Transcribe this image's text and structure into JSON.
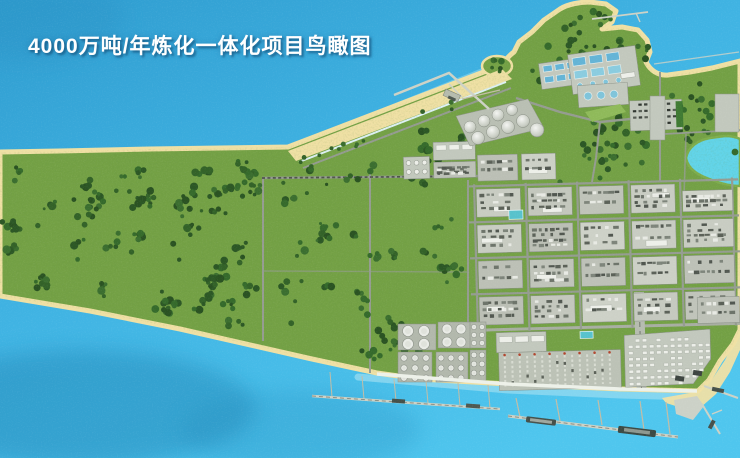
{
  "header": {
    "title": "4000万吨/年炼化一体化项目鸟瞰图"
  },
  "palette": {
    "water": "#3fb0e0",
    "water_light": "#52c6ee",
    "water_deep": "#2387b8",
    "grass": "#74a145",
    "forest": "#2f5c27",
    "sand": "#efe0a4",
    "pad": "#c2c8bd",
    "pad_dark": "#aab0a5",
    "road": "#959c91",
    "white_bldg": "#edefe9",
    "pool_blue": "#64b4d6",
    "pond": "#62d4e8",
    "pond_rim": "#7fae4c",
    "teal_roof": "#57c2cc",
    "red_accent": "#b2452e",
    "pier": "#cdd2c6",
    "trestle": "#c2bda6",
    "ship": "#45504a",
    "seawall": "#edf1e9",
    "harbor_strip": "#96dbf0",
    "rail": "#4e544b"
  }
}
